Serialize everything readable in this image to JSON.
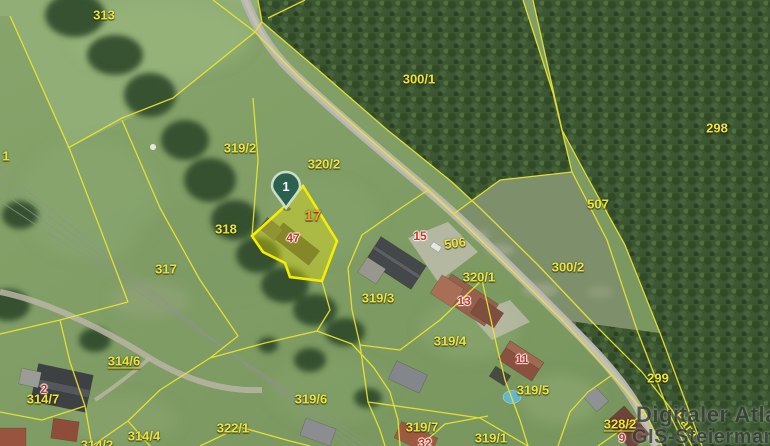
{
  "map": {
    "marker": {
      "label": "1"
    },
    "parcel_labels": [
      {
        "text": "313"
      },
      {
        "text": "300/1"
      },
      {
        "text": "298"
      },
      {
        "text": "319/2"
      },
      {
        "text": "320/2"
      },
      {
        "text": "507"
      },
      {
        "text": "318"
      },
      {
        "text": "317"
      },
      {
        "text": "506"
      },
      {
        "text": "320/1"
      },
      {
        "text": "300/2"
      },
      {
        "text": "319/3"
      },
      {
        "text": "319/4"
      },
      {
        "text": "319/5"
      },
      {
        "text": "314/6"
      },
      {
        "text": "299"
      },
      {
        "text": "314/7"
      },
      {
        "text": "319/6"
      },
      {
        "text": "322/1"
      },
      {
        "text": "319/7"
      },
      {
        "text": "319/1"
      },
      {
        "text": "314/4"
      },
      {
        "text": "314/2"
      },
      {
        "text": "328/2"
      },
      {
        "text": "1"
      },
      {
        "text": "17"
      }
    ],
    "house_numbers": [
      {
        "text": "47"
      },
      {
        "text": "15"
      },
      {
        "text": "13"
      },
      {
        "text": "11"
      },
      {
        "text": "2"
      },
      {
        "text": "9"
      },
      {
        "text": "32"
      }
    ],
    "street_label": {
      "text": "Para"
    },
    "watermark": {
      "line1": "Digitaler Atlas",
      "line2": "GIS-Steiermark"
    },
    "colors": {
      "parcel_line": "#ece62f",
      "highlight_fill": "#f8ee00",
      "house_number": "#c5342b",
      "marker_fill": "#2b5f4e",
      "watermark": "#39403a"
    }
  }
}
